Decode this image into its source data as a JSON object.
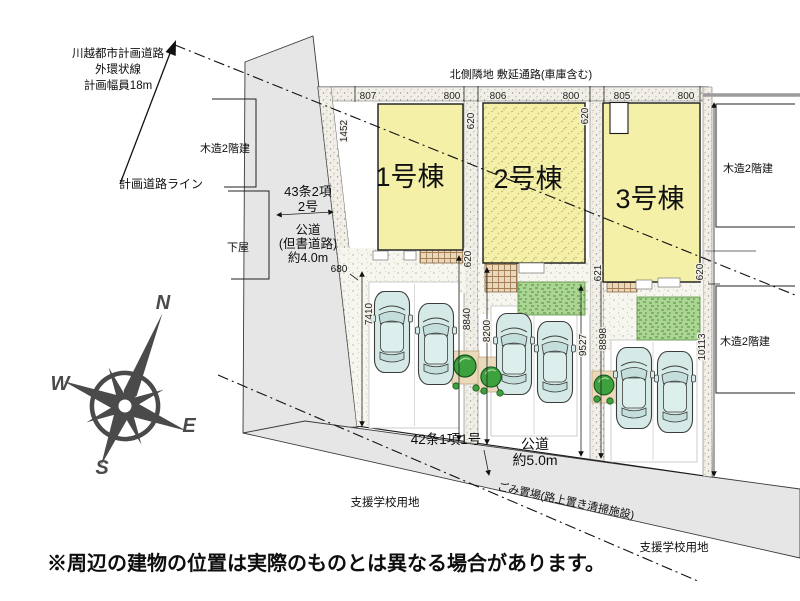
{
  "planned_road_note": {
    "l1": "川越都市計画道路",
    "l2": "外環状線",
    "l3": "計画幅員18m",
    "line_label": "計画道路ライン"
  },
  "north_note": "北側隣地 敷延通路(車庫含む)",
  "west_road": {
    "law1": "43条2項",
    "law2": "2号",
    "type": "公道",
    "note": "(但書道路)",
    "width": "約4.0m"
  },
  "south_road": {
    "law": "42条1項1号",
    "type": "公道",
    "width": "約5.0m",
    "garbage": "ごみ置場(路上置き清掃施設)"
  },
  "school_site_left": "支援学校用地",
  "school_site_right": "支援学校用地",
  "neighbors": {
    "left": "木造2階建",
    "left_sub": "下屋",
    "right_top": "木造2階建",
    "right_bottom": "木造2階建"
  },
  "buildings": {
    "b1": "1号棟",
    "b2": "2号棟",
    "b3": "3号棟"
  },
  "dims": {
    "north": [
      "807",
      "800",
      "806",
      "800",
      "805",
      "800"
    ],
    "west_top": "1452",
    "west_jog": "680",
    "lot1_depth": "7410",
    "d12_top": "620",
    "d12_mid": "620",
    "d12_west": "8840",
    "d12_east": "8200",
    "d23_top": "620",
    "d23_mid": "621",
    "d23_west": "9527",
    "d23_east": "8898",
    "east_mid": "620",
    "east_depth": "10113"
  },
  "compass": {
    "n": "N",
    "e": "E",
    "s": "S",
    "w": "W"
  },
  "colors": {
    "building_fill": "#f4f0a8",
    "road_fill": "#e6e6e6",
    "garden_green": "#aad593",
    "car_fill": "#d5eae7",
    "compass_gray": "#4a4a4a"
  },
  "disclaimer": "※周辺の建物の位置は実際のものとは異なる場合があります。"
}
